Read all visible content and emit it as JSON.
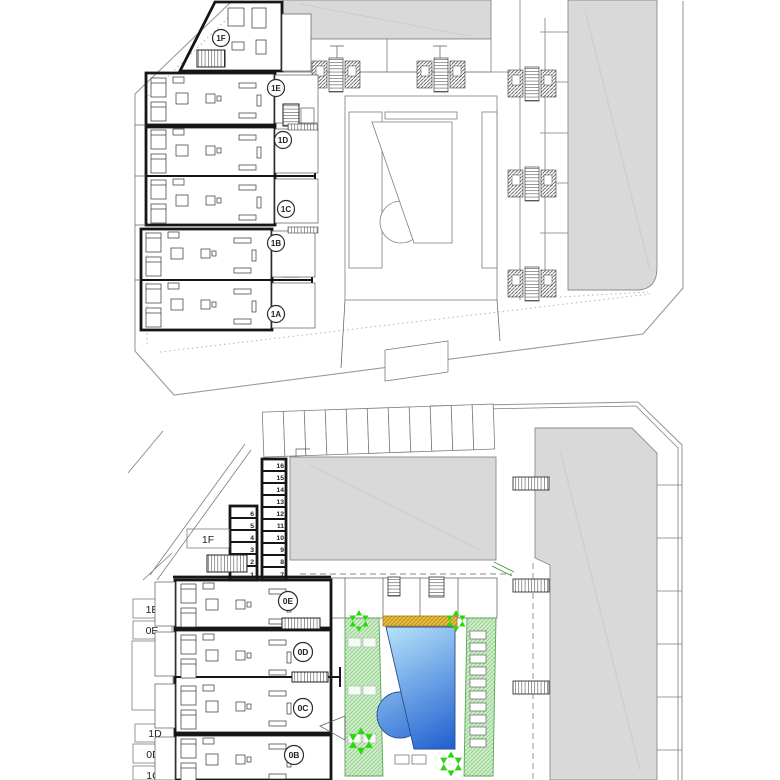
{
  "plans": {
    "upper": {
      "name": "upper floor plan",
      "units": [
        "1F",
        "1E",
        "1D",
        "1C",
        "1B",
        "1A"
      ]
    },
    "lower": {
      "name": "ground floor plan with pool",
      "units": [
        "0E",
        "0D",
        "0C",
        "0B"
      ],
      "entry_boxes": [
        "1F",
        "1E",
        "0E",
        "1D",
        "0D",
        "1C"
      ],
      "storage_left": [
        "6",
        "5",
        "4",
        "3",
        "2",
        "1"
      ],
      "storage_right": [
        "16",
        "15",
        "14",
        "13",
        "12",
        "11",
        "10",
        "9",
        "8",
        "7"
      ]
    }
  },
  "colors": {
    "building_fill": "#d9d9d9",
    "pool_light": "#b8e4fa",
    "pool_dark": "#1e5ed0",
    "lawn": "#d8efcf",
    "tree": "#2bd80f",
    "deck_bar": "#eec743"
  }
}
